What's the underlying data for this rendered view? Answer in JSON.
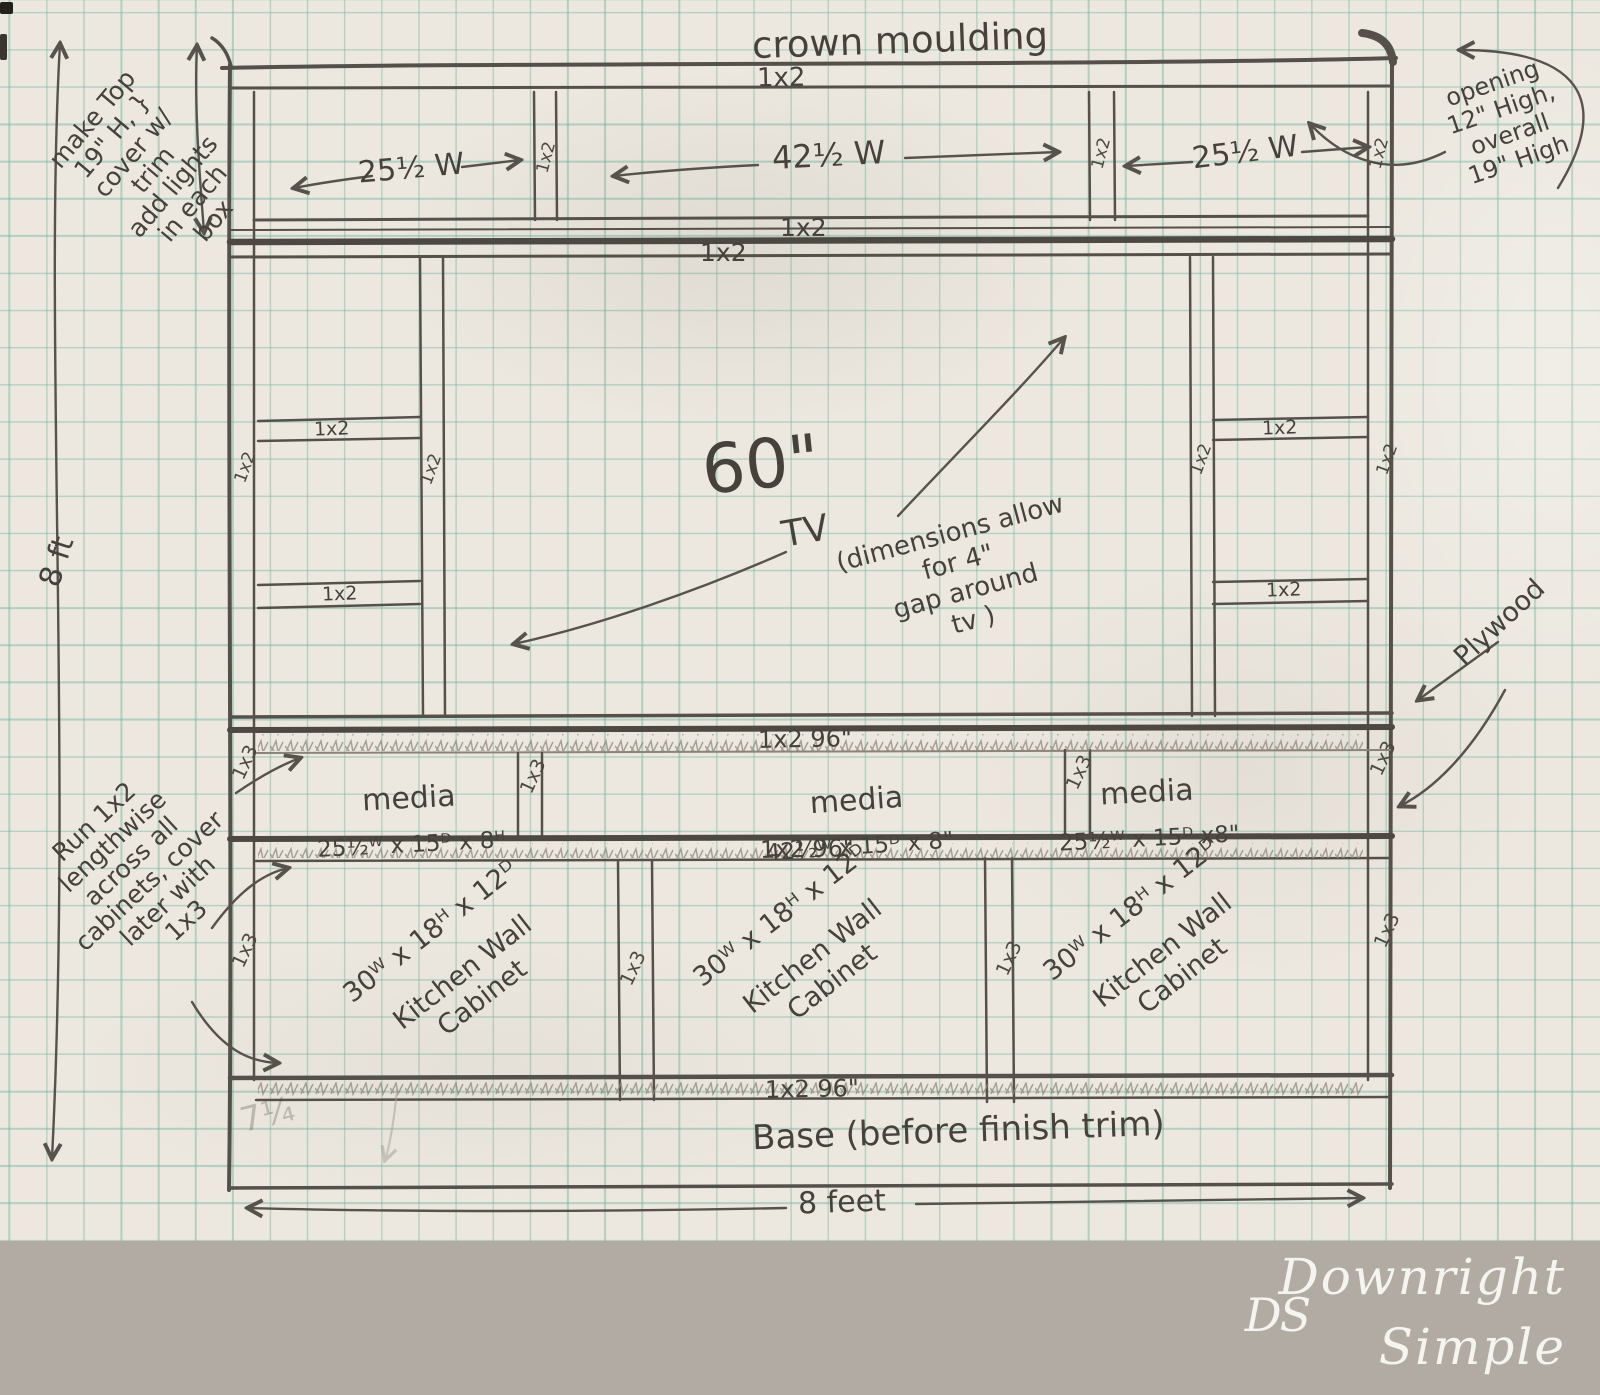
{
  "title": "crown moulding",
  "lumber": {
    "one_by_two": "1x2",
    "one_by_three": "1x3",
    "rail_96": "1x2    96\""
  },
  "dimensions": {
    "left_width": "25½ W",
    "center_width": "42½ W",
    "right_width": "25½ W",
    "height_8ft": "8 ft",
    "bottom_8feet": "8 feet",
    "base_faint": "7¼"
  },
  "annotations": {
    "make_top": "make Top\n19\" H, }\ncover w/\ntrim\nadd lights\nin each\nbox",
    "opening": "opening\n12\" High,\noverall\n19\" High",
    "tv_gap": "(dimensions allow\nfor 4\"\ngap around\ntv   )",
    "plywood": "Plywood",
    "run_1x2": "Run 1x2\nlengthwise\nacross all\ncabinets, cover\nlater with\n1x3",
    "base": "Base   (before  finish trim)"
  },
  "tv": {
    "size": "60\"",
    "label": "TV"
  },
  "media_boxes": [
    {
      "name": "media",
      "dims": "25½ᵂ x 15ᴰ x 8ᴴ"
    },
    {
      "name": "media",
      "dims": "42½ᵂ x 15ᴰ x 8\""
    },
    {
      "name": "media",
      "dims": "25½ᵂ x 15ᴰ x8\""
    }
  ],
  "cabinets": [
    {
      "dims": "30ᵂ x 18ᴴ x 12ᴰ",
      "label": "Kitchen Wall\nCabinet"
    },
    {
      "dims": "30ᵂ x 18ᴴ x 12ᴰ",
      "label": "Kitchen Wall\nCabinet"
    },
    {
      "dims": "30ᵂ x 18ᴴ x 12ᴰ",
      "label": "Kitchen Wall\nCabinet"
    }
  ],
  "footer": {
    "monogram": "DS",
    "brand_line1": "Downright",
    "brand_line2": "Simple"
  }
}
